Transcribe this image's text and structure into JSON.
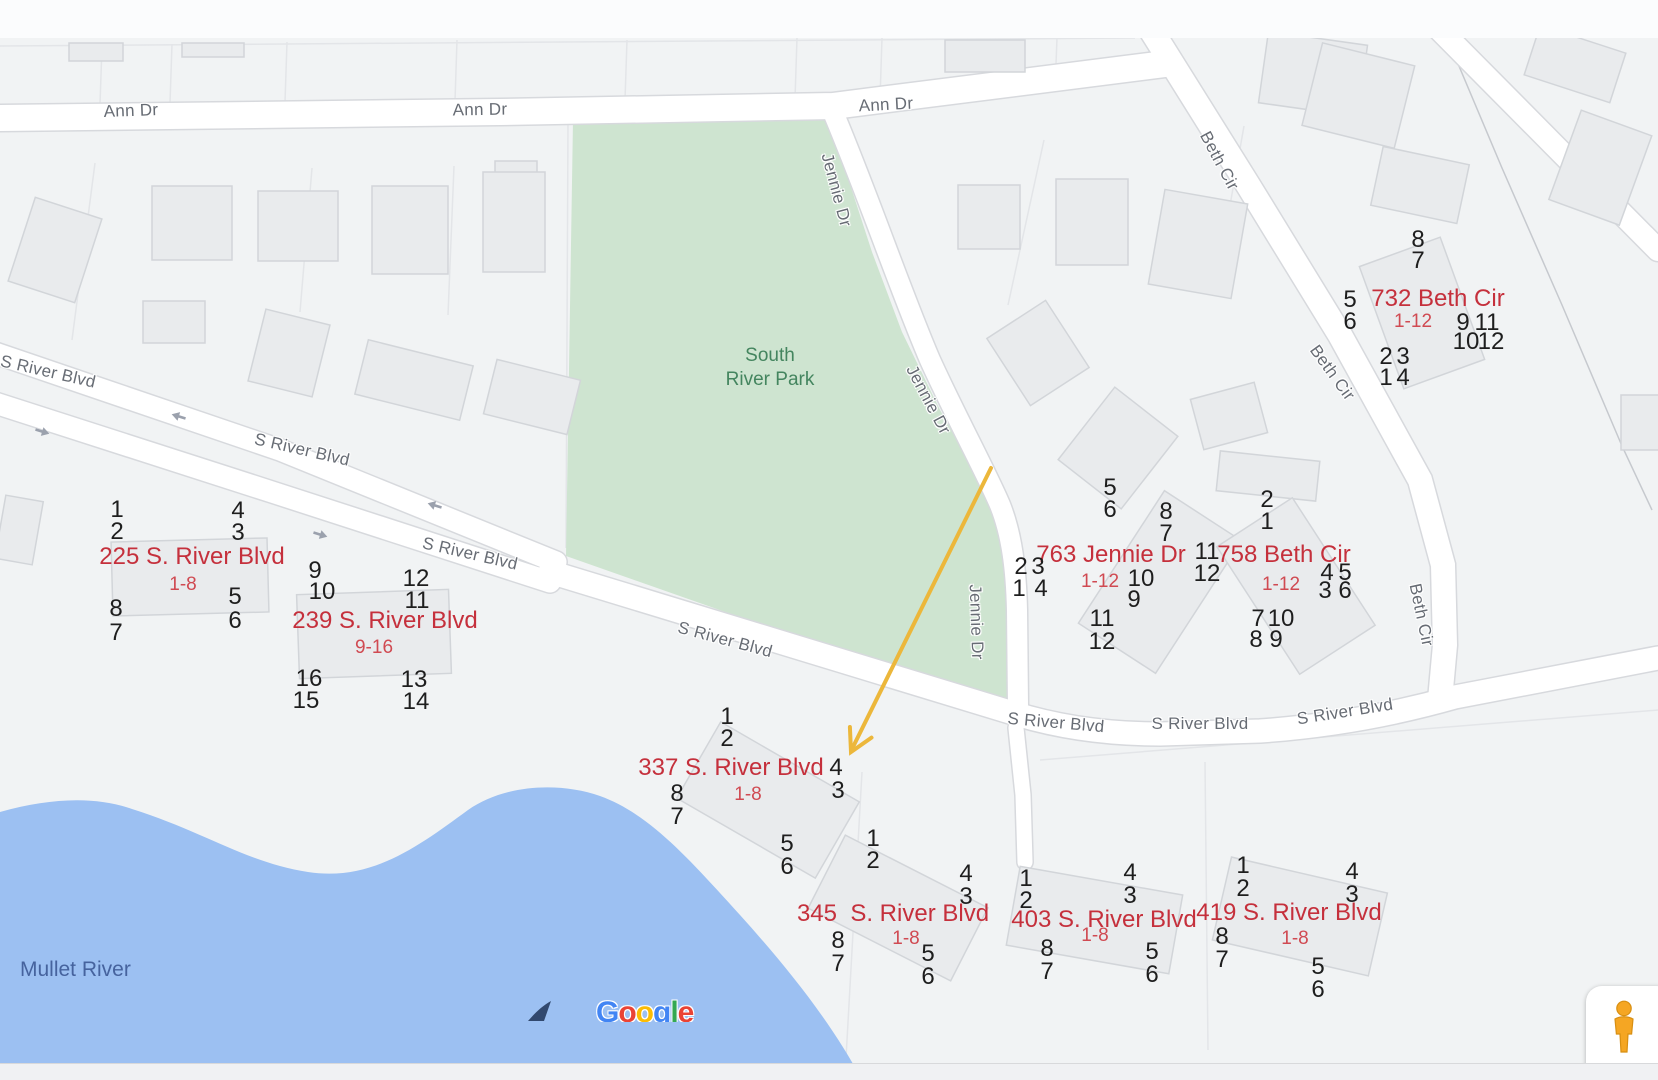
{
  "colors": {
    "map_bg": "#f1f3f4",
    "road_fill": "#ffffff",
    "road_casing": "#d7d9dd",
    "building_fill": "#e9ebed",
    "building_stroke": "#d2d5d9",
    "parcel": "#e3e5e8",
    "park_fill": "#cee4d0",
    "park_text": "#44855f",
    "water_fill": "#9cc0f2",
    "water_text": "#46639e",
    "road_text": "#676c74",
    "annotation_red": "#c5303c",
    "annotation_red_light": "#d04a52",
    "number_black": "#1e1e1e",
    "arrow_orange": "#ecb73b",
    "oneway_gray": "#9ba1ad",
    "pegman_orange": "#f5a623"
  },
  "park": {
    "line1": "South",
    "line2": "River Park"
  },
  "water_label": {
    "text": "Mullet River"
  },
  "attribution": {
    "text": "Google",
    "letter_colors": [
      "#4285F4",
      "#EA4335",
      "#FBBC05",
      "#4285F4",
      "#34A853",
      "#EA4335"
    ]
  },
  "road_labels": [
    {
      "text": "Ann Dr",
      "x": 131,
      "y": 111,
      "angle": -2
    },
    {
      "text": "Ann Dr",
      "x": 480,
      "y": 110,
      "angle": -1
    },
    {
      "text": "Ann Dr",
      "x": 886,
      "y": 105,
      "angle": -3
    },
    {
      "text": "S River Blvd",
      "x": 48,
      "y": 372,
      "angle": 13
    },
    {
      "text": "S River Blvd",
      "x": 302,
      "y": 450,
      "angle": 13
    },
    {
      "text": "S River Blvd",
      "x": 470,
      "y": 554,
      "angle": 13
    },
    {
      "text": "S River Blvd",
      "x": 725,
      "y": 640,
      "angle": 15
    },
    {
      "text": "S River Blvd",
      "x": 1056,
      "y": 723,
      "angle": 5
    },
    {
      "text": "S River Blvd",
      "x": 1200,
      "y": 724,
      "angle": 0
    },
    {
      "text": "S River Blvd",
      "x": 1345,
      "y": 712,
      "angle": -9
    },
    {
      "text": "Jennie Dr",
      "x": 836,
      "y": 190,
      "angle": 75
    },
    {
      "text": "Jennie Dr",
      "x": 928,
      "y": 400,
      "angle": 62
    },
    {
      "text": "Jennie Dr",
      "x": 976,
      "y": 622,
      "angle": 88
    },
    {
      "text": "Beth Cir",
      "x": 1219,
      "y": 161,
      "angle": 62
    },
    {
      "text": "Beth Cir",
      "x": 1332,
      "y": 373,
      "angle": 54
    },
    {
      "text": "Beth Cir",
      "x": 1421,
      "y": 615,
      "angle": 78
    }
  ],
  "oneway_arrows": [
    {
      "x": 44,
      "y": 429,
      "angle": 17
    },
    {
      "x": 177,
      "y": 419,
      "angle": 197
    },
    {
      "x": 322,
      "y": 532,
      "angle": 17
    },
    {
      "x": 433,
      "y": 508,
      "angle": 197
    }
  ],
  "annotations": [
    {
      "address": "225 S. River Blvd",
      "range": "1-8",
      "label": {
        "x": 192,
        "y": 557
      },
      "range_pos": {
        "x": 183,
        "y": 585
      },
      "units": [
        [
          "1",
          117,
          510
        ],
        [
          "2",
          117,
          532
        ],
        [
          "4",
          238,
          511
        ],
        [
          "3",
          238,
          533
        ],
        [
          "8",
          116,
          609
        ],
        [
          "7",
          116,
          633
        ],
        [
          "5",
          235,
          597
        ],
        [
          "6",
          235,
          621
        ]
      ]
    },
    {
      "address": "239 S. River Blvd",
      "range": "9-16",
      "label": {
        "x": 385,
        "y": 621
      },
      "range_pos": {
        "x": 374,
        "y": 648
      },
      "units": [
        [
          "9",
          315,
          571
        ],
        [
          "10",
          322,
          592
        ],
        [
          "12",
          416,
          579
        ],
        [
          "11",
          417,
          601
        ],
        [
          "16",
          309,
          679
        ],
        [
          "15",
          306,
          701
        ],
        [
          "13",
          414,
          680
        ],
        [
          "14",
          416,
          702
        ]
      ]
    },
    {
      "address": "337 S. River Blvd",
      "range": "1-8",
      "label": {
        "x": 731,
        "y": 768
      },
      "range_pos": {
        "x": 748,
        "y": 795
      },
      "units": [
        [
          "1",
          727,
          717
        ],
        [
          "2",
          727,
          739
        ],
        [
          "4",
          836,
          768
        ],
        [
          "3",
          838,
          791
        ],
        [
          "8",
          677,
          794
        ],
        [
          "7",
          677,
          817
        ],
        [
          "5",
          787,
          844
        ],
        [
          "6",
          787,
          867
        ]
      ]
    },
    {
      "address": "345  S. River Blvd",
      "range": "1-8",
      "label": {
        "x": 893,
        "y": 914
      },
      "range_pos": {
        "x": 906,
        "y": 939
      },
      "units": [
        [
          "1",
          873,
          839
        ],
        [
          "2",
          873,
          861
        ],
        [
          "4",
          966,
          874
        ],
        [
          "3",
          966,
          897
        ],
        [
          "8",
          838,
          941
        ],
        [
          "7",
          838,
          964
        ],
        [
          "5",
          928,
          954
        ],
        [
          "6",
          928,
          977
        ]
      ]
    },
    {
      "address": "403 S. River Blvd",
      "range": "1-8",
      "label": {
        "x": 1104,
        "y": 920
      },
      "range_pos": {
        "x": 1095,
        "y": 936
      },
      "units": [
        [
          "1",
          1026,
          879
        ],
        [
          "2",
          1026,
          901
        ],
        [
          "4",
          1130,
          873
        ],
        [
          "3",
          1130,
          896
        ],
        [
          "8",
          1047,
          949
        ],
        [
          "7",
          1047,
          972
        ],
        [
          "5",
          1152,
          952
        ],
        [
          "6",
          1152,
          975
        ]
      ]
    },
    {
      "address": "419 S. River Blvd",
      "range": "1-8",
      "label": {
        "x": 1289,
        "y": 913
      },
      "range_pos": {
        "x": 1295,
        "y": 939
      },
      "units": [
        [
          "1",
          1243,
          866
        ],
        [
          "2",
          1243,
          889
        ],
        [
          "4",
          1352,
          872
        ],
        [
          "3",
          1352,
          895
        ],
        [
          "8",
          1222,
          937
        ],
        [
          "7",
          1222,
          960
        ],
        [
          "5",
          1318,
          967
        ],
        [
          "6",
          1318,
          990
        ]
      ]
    },
    {
      "address": "763 Jennie Dr",
      "range": "1-12",
      "label": {
        "x": 1111,
        "y": 555
      },
      "range_pos": {
        "x": 1100,
        "y": 582
      },
      "units": [
        [
          "5",
          1110,
          488
        ],
        [
          "6",
          1110,
          510
        ],
        [
          "8",
          1166,
          512
        ],
        [
          "7",
          1166,
          534
        ],
        [
          "2",
          1021,
          567
        ],
        [
          "3",
          1038,
          567
        ],
        [
          "1",
          1019,
          589
        ],
        [
          "4",
          1041,
          589
        ],
        [
          "10",
          1141,
          579
        ],
        [
          "9",
          1134,
          600
        ],
        [
          "11",
          1102,
          619
        ],
        [
          "12",
          1102,
          642
        ]
      ]
    },
    {
      "address": "758 Beth Cir",
      "range": "1-12",
      "label": {
        "x": 1284,
        "y": 555
      },
      "range_pos": {
        "x": 1281,
        "y": 585
      },
      "units": [
        [
          "2",
          1267,
          500
        ],
        [
          "1",
          1267,
          522
        ],
        [
          "11",
          1207,
          552
        ],
        [
          "12",
          1207,
          574
        ],
        [
          "4",
          1327,
          573
        ],
        [
          "5",
          1345,
          573
        ],
        [
          "3",
          1325,
          591
        ],
        [
          "6",
          1345,
          591
        ],
        [
          "7",
          1258,
          619
        ],
        [
          "10",
          1281,
          619
        ],
        [
          "8",
          1256,
          640
        ],
        [
          "9",
          1276,
          640
        ]
      ]
    },
    {
      "address": "732 Beth Cir",
      "range": "1-12",
      "label": {
        "x": 1438,
        "y": 299
      },
      "range_pos": {
        "x": 1413,
        "y": 322
      },
      "units": [
        [
          "8",
          1418,
          240
        ],
        [
          "7",
          1418,
          261
        ],
        [
          "5",
          1350,
          300
        ],
        [
          "6",
          1350,
          322
        ],
        [
          "9",
          1463,
          323
        ],
        [
          "11",
          1487,
          323
        ],
        [
          "10",
          1466,
          342
        ],
        [
          "12",
          1491,
          342
        ],
        [
          "2",
          1386,
          357
        ],
        [
          "3",
          1403,
          357
        ],
        [
          "1",
          1386,
          378
        ],
        [
          "4",
          1403,
          378
        ]
      ]
    }
  ]
}
